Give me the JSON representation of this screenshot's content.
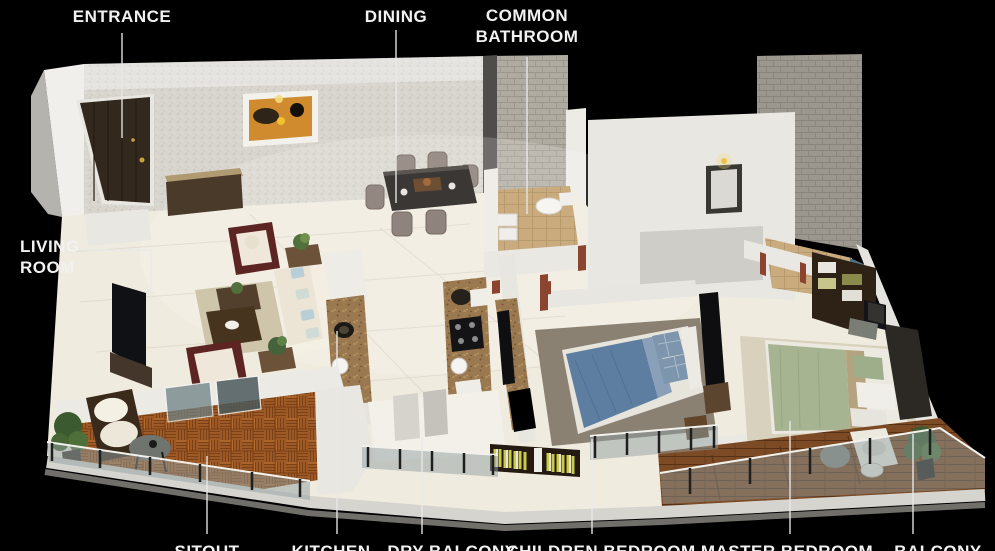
{
  "scene": {
    "type": "3d-isometric-apartment-floor-plan",
    "background": "#000000",
    "text_color": "#f1f1f1",
    "leader_line_color": "#e9e9e9"
  },
  "labels": {
    "entrance": "ENTRANCE",
    "dining": "DINING",
    "common_bathroom": [
      "COMMON",
      "BATHROOM"
    ],
    "living_room": [
      "LIVING",
      "ROOM"
    ],
    "sitout": "SITOUT",
    "kitchen": "KITCHEN",
    "dry_balcony": "DRY BALCONY",
    "children_bedroom": "CHILDREN BEDROOM",
    "master_bedroom": "MASTER BEDROOM",
    "balcony": "BALCONY"
  },
  "materials": {
    "wallpaper_wall": "#d8d5ce",
    "interior_floor": "#f0ebdf",
    "sitout_parquet": "#9d5a26",
    "balcony_wood": "#7c4a25",
    "kitchen_granite": "#9b7950",
    "bathroom_floor_tile": "#c9ab7d",
    "bathroom_wall_tile": "#b0aba1",
    "glass_railing": "#8fa0a2",
    "entrance_door": "#33281e",
    "children_bed": "#5e7ea1",
    "master_bed": "#a7b491",
    "sofa": "#ece5d6",
    "accent_armchair": "#5c2422",
    "door_jamb_accent": "#8a4430"
  }
}
